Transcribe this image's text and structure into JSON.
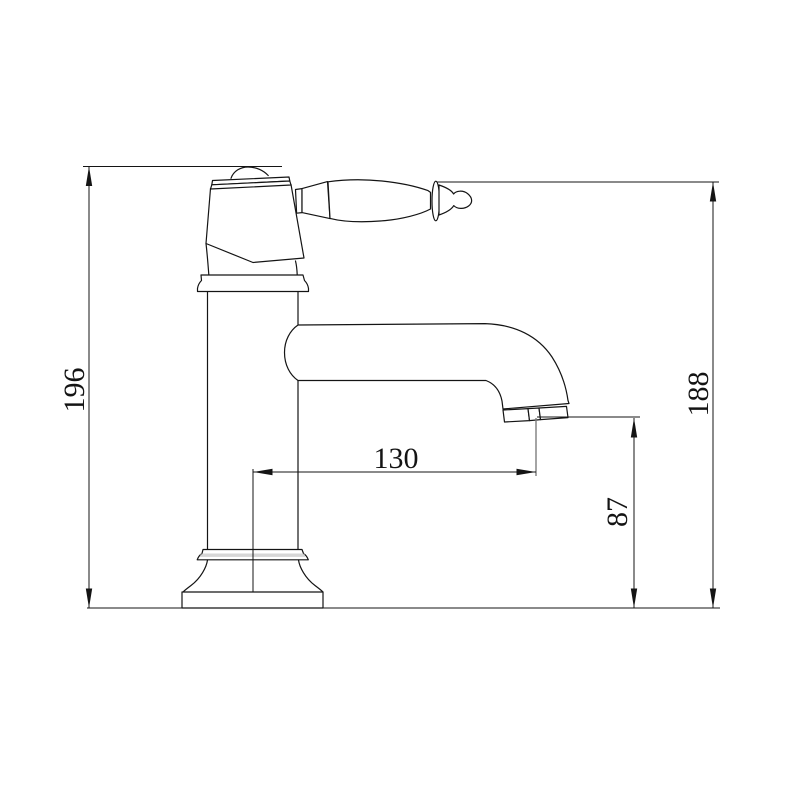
{
  "drawing": {
    "subject": "single-handle basin faucet, dimensioned side elevation",
    "background_color": "#ffffff",
    "line_color": "#141414"
  },
  "dimensions": {
    "overall_height": "196",
    "handle_tip_height": "188",
    "spout_reach": "130",
    "outlet_height": "87"
  }
}
